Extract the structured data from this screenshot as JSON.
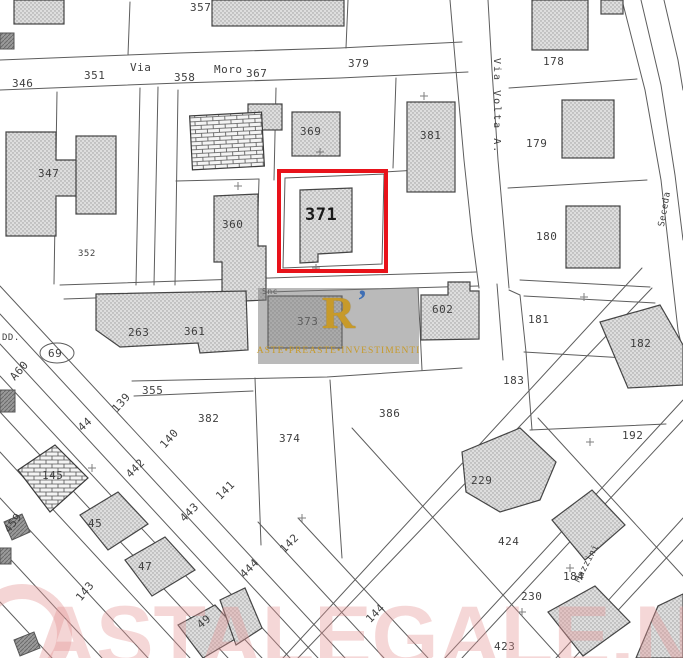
{
  "map": {
    "type": "cadastral-parcel-map",
    "highlight": {
      "parcel": "371",
      "color": "#e8121a"
    },
    "colors": {
      "background": "#ffffff",
      "parcel_line": "#5d5d5d",
      "building_fill": "#dedede",
      "building_outline": "#454545",
      "label": "#3f3f3f"
    },
    "street_names": [
      "Via Moro",
      "Via Volta A.",
      "Seceda",
      "Mazzini"
    ],
    "labels": [
      {
        "text": "357",
        "x": 190,
        "y": 2
      },
      {
        "text": "346",
        "x": 12,
        "y": 78
      },
      {
        "text": "351",
        "x": 84,
        "y": 70
      },
      {
        "text": "Via",
        "x": 130,
        "y": 62
      },
      {
        "text": "358",
        "x": 174,
        "y": 72
      },
      {
        "text": "Moro",
        "x": 214,
        "y": 64
      },
      {
        "text": "367",
        "x": 246,
        "y": 68
      },
      {
        "text": "379",
        "x": 348,
        "y": 58
      },
      {
        "text": "369",
        "x": 300,
        "y": 126
      },
      {
        "text": "381",
        "x": 420,
        "y": 130
      },
      {
        "text": "178",
        "x": 543,
        "y": 56
      },
      {
        "text": "179",
        "x": 526,
        "y": 138
      },
      {
        "text": "Via Volta A.",
        "x": 491,
        "y": 58,
        "vertical": true,
        "size": 10
      },
      {
        "text": "347",
        "x": 38,
        "y": 168
      },
      {
        "text": "352",
        "x": 78,
        "y": 250,
        "size": 9
      },
      {
        "text": "360",
        "x": 222,
        "y": 219
      },
      {
        "text": "371",
        "x": 305,
        "y": 207,
        "size": 17,
        "bold": true,
        "color": "#1a1a1a"
      },
      {
        "text": "180",
        "x": 536,
        "y": 231
      },
      {
        "text": "Seceda",
        "x": 658,
        "y": 226,
        "rot": -80,
        "size": 9
      },
      {
        "text": "181",
        "x": 528,
        "y": 314
      },
      {
        "text": "182",
        "x": 630,
        "y": 338
      },
      {
        "text": "183",
        "x": 503,
        "y": 375
      },
      {
        "text": "192",
        "x": 622,
        "y": 430
      },
      {
        "text": "602",
        "x": 432,
        "y": 304
      },
      {
        "text": "373",
        "x": 297,
        "y": 316
      },
      {
        "text": "Snc",
        "x": 262,
        "y": 288,
        "size": 8
      },
      {
        "text": "263",
        "x": 128,
        "y": 327
      },
      {
        "text": "361",
        "x": 184,
        "y": 326
      },
      {
        "text": "DD.",
        "x": 2,
        "y": 334,
        "size": 9
      },
      {
        "text": "69",
        "x": 48,
        "y": 348
      },
      {
        "text": "A60",
        "x": 8,
        "y": 375,
        "rot": -48
      },
      {
        "text": "139",
        "x": 110,
        "y": 407,
        "rot": -48
      },
      {
        "text": "44",
        "x": 76,
        "y": 425,
        "rot": -42
      },
      {
        "text": "140",
        "x": 158,
        "y": 443,
        "rot": -48
      },
      {
        "text": "442",
        "x": 124,
        "y": 472,
        "rot": -45
      },
      {
        "text": "141",
        "x": 214,
        "y": 494,
        "rot": -45
      },
      {
        "text": "443",
        "x": 178,
        "y": 516,
        "rot": -45
      },
      {
        "text": "145",
        "x": 42,
        "y": 470
      },
      {
        "text": "459",
        "x": 2,
        "y": 528,
        "rot": -52
      },
      {
        "text": "45",
        "x": 88,
        "y": 518
      },
      {
        "text": "47",
        "x": 138,
        "y": 561
      },
      {
        "text": "143",
        "x": 74,
        "y": 596,
        "rot": -50
      },
      {
        "text": "142",
        "x": 278,
        "y": 547,
        "rot": -45
      },
      {
        "text": "444",
        "x": 238,
        "y": 572,
        "rot": -45
      },
      {
        "text": "144",
        "x": 364,
        "y": 617,
        "rot": -45
      },
      {
        "text": "49",
        "x": 195,
        "y": 622,
        "rot": -40
      },
      {
        "text": "355",
        "x": 142,
        "y": 385
      },
      {
        "text": "382",
        "x": 198,
        "y": 413
      },
      {
        "text": "374",
        "x": 279,
        "y": 433
      },
      {
        "text": "386",
        "x": 379,
        "y": 408
      },
      {
        "text": "229",
        "x": 471,
        "y": 475
      },
      {
        "text": "424",
        "x": 498,
        "y": 536
      },
      {
        "text": "184",
        "x": 563,
        "y": 571
      },
      {
        "text": "230",
        "x": 521,
        "y": 591
      },
      {
        "text": "423",
        "x": 494,
        "y": 641
      },
      {
        "text": "Mazzini",
        "x": 574,
        "y": 580,
        "rot": -62,
        "size": 9
      }
    ]
  },
  "watermarks": {
    "center": {
      "logo_letter": "R",
      "logo_accent": "’",
      "text": "ASTE•PREASTE•INVESTIMENTI",
      "gold": "#c79a2a",
      "blue": "#3f6fb5",
      "background": "#7a7a7a"
    },
    "bottom": {
      "text": "ASTALEGALE.NET",
      "color": "#e49696"
    }
  }
}
